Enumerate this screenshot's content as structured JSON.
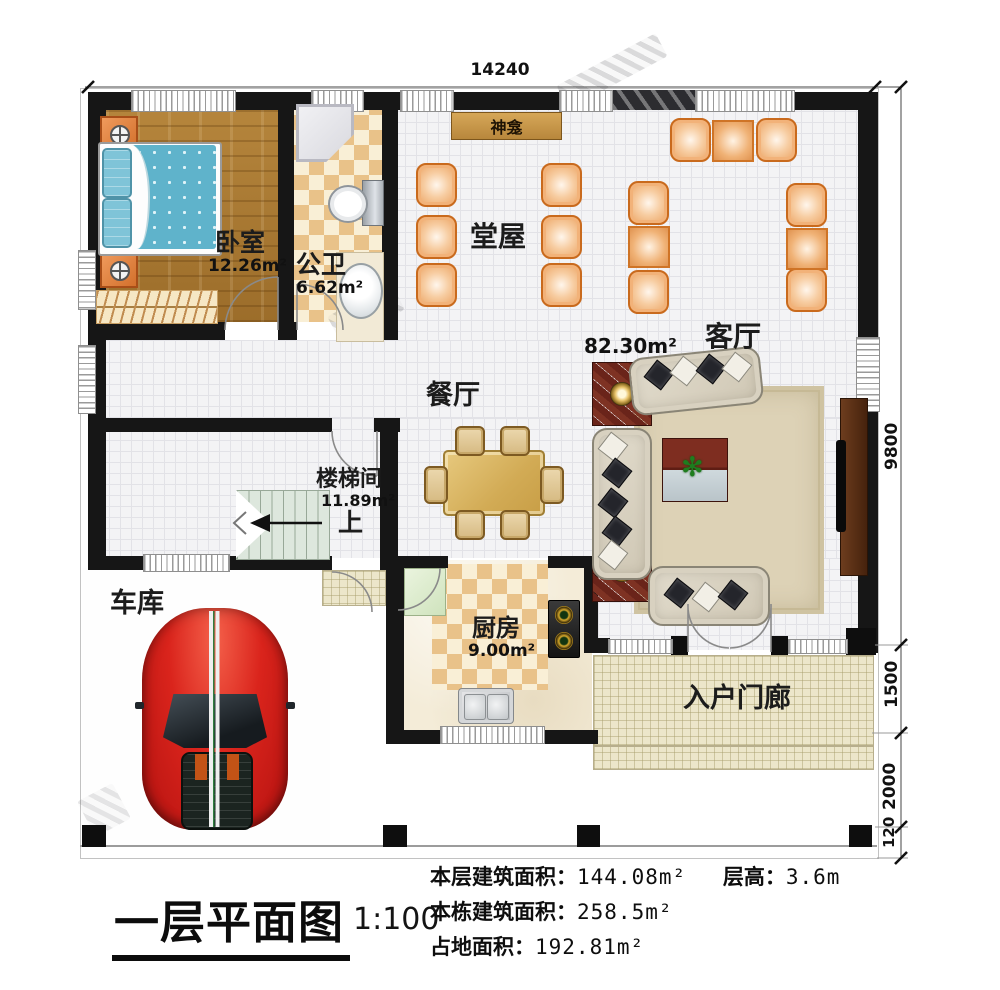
{
  "title_block": {
    "plan_title": "一层平面图",
    "scale": "1:100",
    "stats": [
      {
        "label": "本层建筑面积：",
        "value": "144.08m²"
      },
      {
        "label": "层高：",
        "value": "3.6m"
      },
      {
        "label": "本栋建筑面积：",
        "value": "258.5m²"
      },
      {
        "label": "占地面积：",
        "value": "192.81m²"
      }
    ]
  },
  "dimensions": {
    "top_width": "14240",
    "right_main": "9800",
    "right_porch": "1500",
    "right_front": "2000",
    "right_edge": "120"
  },
  "rooms": {
    "bedroom": {
      "name": "卧室",
      "area": "12.26m²"
    },
    "bathroom": {
      "name": "公卫",
      "area": "6.62m²"
    },
    "hall": {
      "name": "堂屋"
    },
    "shrine_label": "神龛",
    "living": {
      "name": "客厅",
      "area": "82.30m²"
    },
    "dining": {
      "name": "餐厅"
    },
    "stairwell": {
      "name": "楼梯间",
      "area": "11.89m²",
      "direction": "上"
    },
    "garage": {
      "name": "车库"
    },
    "kitchen": {
      "name": "厨房",
      "area": "9.00m²"
    },
    "porch": {
      "name": "入户门廊"
    }
  },
  "colors": {
    "wall": "#161616",
    "wood_floor": "#ab7a33",
    "tile_checker": "#e9c289",
    "chair_orange": "#eba260",
    "car_red": "#da241c",
    "shrine_wood": "#c3913f",
    "stair_green": "#dde7dd"
  }
}
